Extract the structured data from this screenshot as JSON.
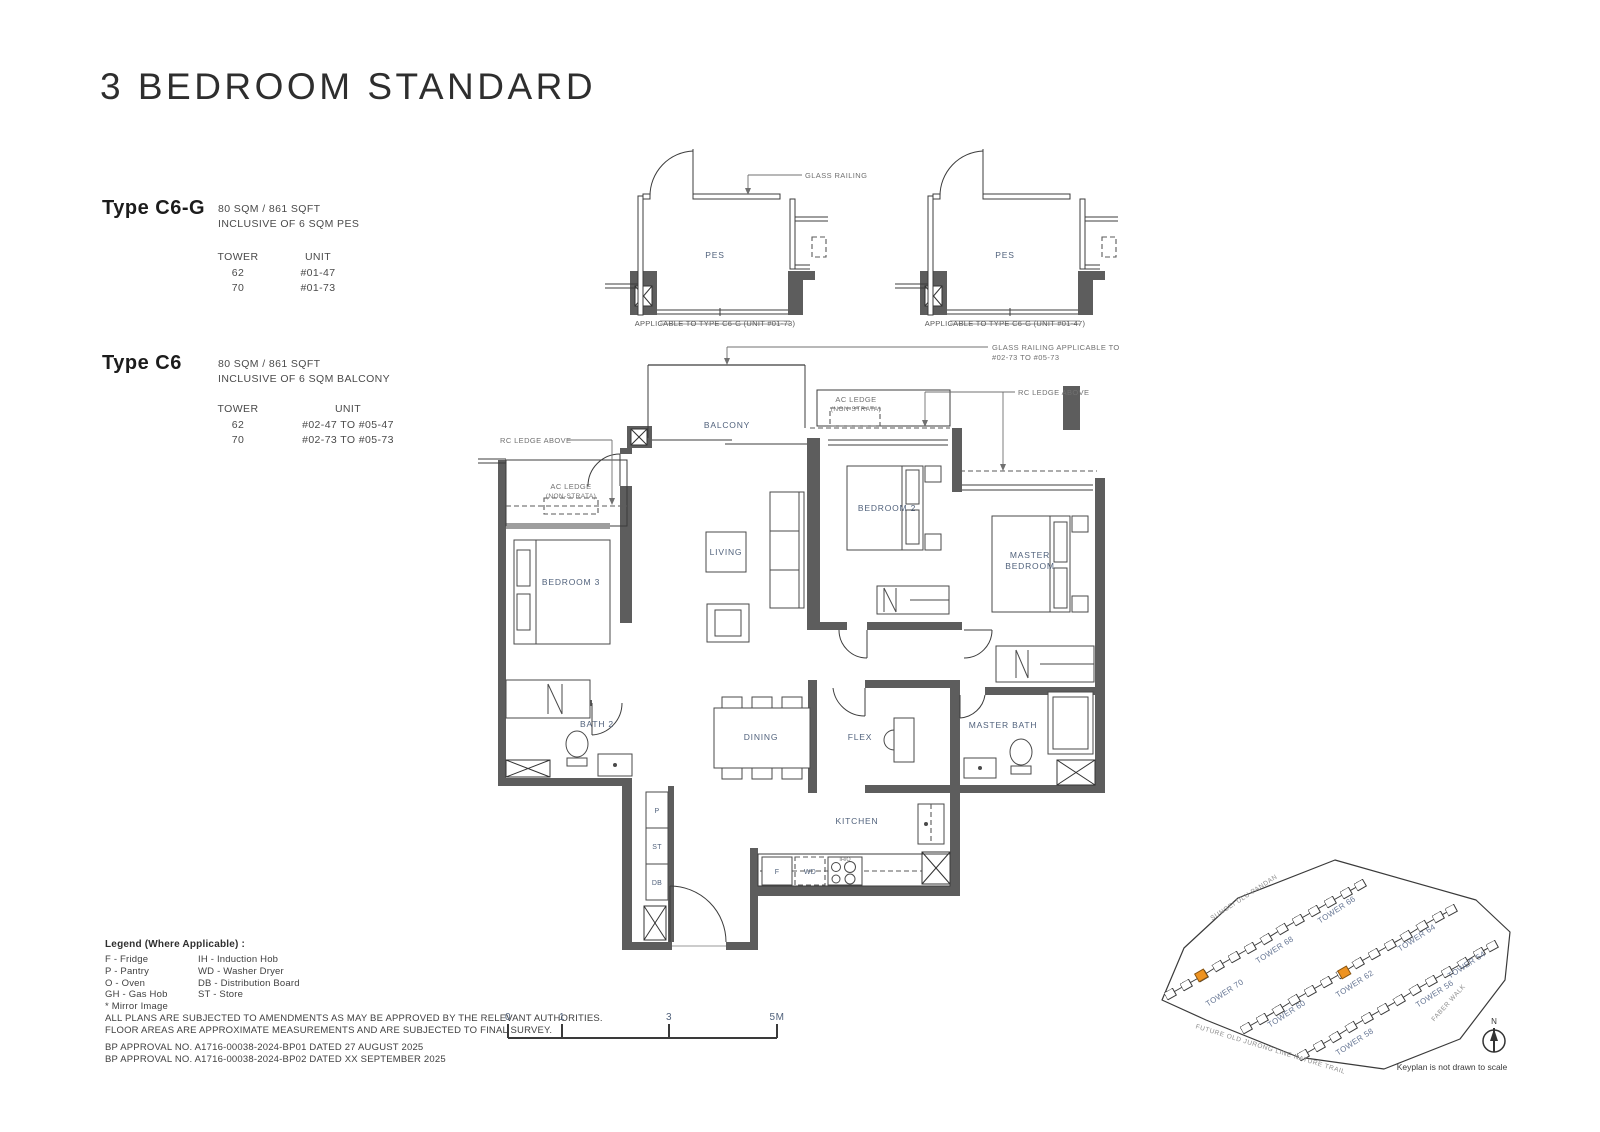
{
  "title": "3 BEDROOM STANDARD",
  "type_c6g": {
    "name": "Type C6-G",
    "area": "80 SQM / 861 SQFT",
    "inclusive": "INCLUSIVE OF 6 SQM PES",
    "tower_header": "TOWER",
    "unit_header": "UNIT",
    "rows": [
      {
        "tower": "62",
        "unit": "#01-47"
      },
      {
        "tower": "70",
        "unit": "#01-73"
      }
    ]
  },
  "type_c6": {
    "name": "Type C6",
    "area": "80 SQM / 861 SQFT",
    "inclusive": "INCLUSIVE OF 6 SQM BALCONY",
    "tower_header": "TOWER",
    "unit_header": "UNIT",
    "rows": [
      {
        "tower": "62",
        "unit": "#02-47 TO #05-47"
      },
      {
        "tower": "70",
        "unit": "#02-73 TO #05-73"
      }
    ]
  },
  "pes_diagrams": {
    "room_label": "PES",
    "caption_left": "APPLICABLE TO TYPE C6-G (UNIT #01-73)",
    "caption_right": "APPLICABLE TO TYPE C6-G (UNIT #01-47)",
    "glass_railing_label": "GLASS RAILING"
  },
  "plan": {
    "rooms": {
      "balcony": "BALCONY",
      "living": "LIVING",
      "bedroom3": "BEDROOM 3",
      "bedroom2": "BEDROOM 2",
      "master_line1": "MASTER",
      "master_line2": "BEDROOM",
      "bath2": "BATH 2",
      "dining": "DINING",
      "flex": "FLEX",
      "master_bath": "MASTER BATH",
      "kitchen": "KITCHEN"
    },
    "fixtures": {
      "pantry": "P",
      "store": "ST",
      "db": "DB",
      "fridge": "F",
      "washer_dryer": "WD",
      "hob": "IH/O"
    },
    "annotations": {
      "rc_ledge_left": "RC LEDGE ABOVE",
      "rc_ledge_right": "RC LEDGE ABOVE",
      "ac_ledge": "AC LEDGE",
      "non_strata": "(NON-STRATA)",
      "glass_railing_line1": "GLASS RAILING APPLICABLE TO:",
      "glass_railing_line2": "#02-73 TO #05-73"
    }
  },
  "legend": {
    "title": "Legend (Where Applicable) :",
    "col1": [
      "F - Fridge",
      "P - Pantry",
      "O - Oven",
      "GH - Gas Hob",
      "* Mirror Image"
    ],
    "col2": [
      "IH - Induction Hob",
      "WD - Washer Dryer",
      "DB - Distribution Board",
      "ST - Store"
    ]
  },
  "disclaimer": [
    "ALL PLANS ARE SUBJECTED TO AMENDMENTS AS MAY BE APPROVED BY THE RELEVANT AUTHORITIES.",
    "FLOOR AREAS ARE APPROXIMATE MEASUREMENTS AND ARE SUBJECTED TO FINAL SURVEY."
  ],
  "bp_approvals": [
    "BP APPROVAL NO. A1716-00038-2024-BP01  DATED 27 AUGUST 2025",
    "BP APPROVAL NO. A1716-00038-2024-BP02  DATED XX SEPTEMBER 2025"
  ],
  "scale_bar": {
    "labels": [
      "0",
      "1",
      "3",
      "5M"
    ]
  },
  "keyplan": {
    "towers": [
      "TOWER 70",
      "TOWER 68",
      "TOWER 66",
      "TOWER 60",
      "TOWER 62",
      "TOWER 64",
      "TOWER 58",
      "TOWER 56",
      "TOWER 54"
    ],
    "streets": {
      "top": "SUNGEI ULU PANDAN",
      "bottom": "FUTURE OLD JURONG LINE NATURE TRAIL",
      "right": "FABER WALK"
    },
    "north_label": "N",
    "caption": "Keyplan is not drawn to scale",
    "highlight_color": "#ee9321"
  },
  "colors": {
    "wall": "#5d5d5d",
    "room_label": "#51627c",
    "annotation": "#707070",
    "highlight": "#ee9321"
  }
}
